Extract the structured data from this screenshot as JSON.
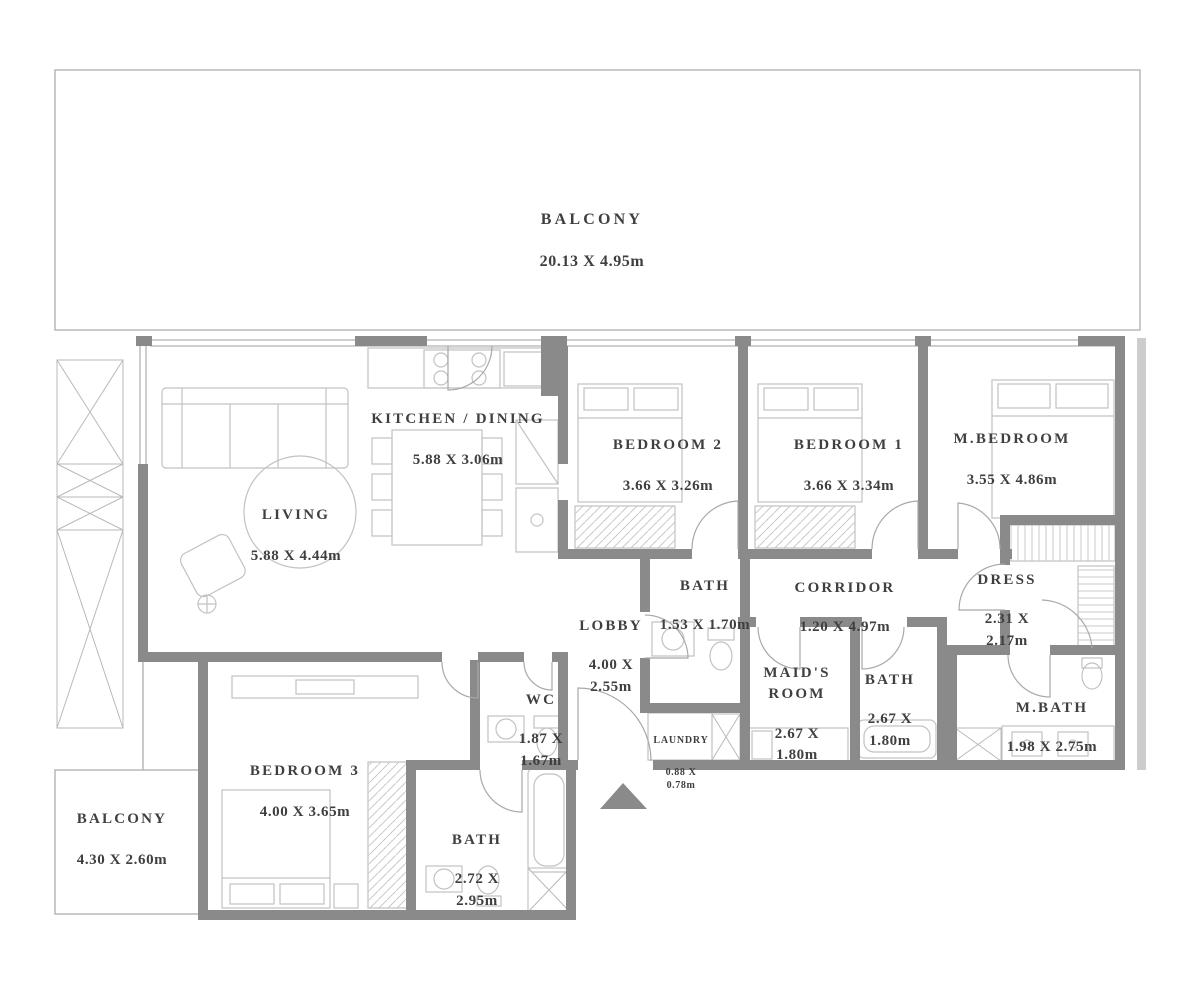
{
  "plan": {
    "type": "apartment-floor-plan",
    "rooms": [
      {
        "id": "balcony-top",
        "name": "BALCONY",
        "dims": "20.13 X 4.95m"
      },
      {
        "id": "kitchen-dining",
        "name": "KITCHEN / DINING",
        "dims": "5.88 X 3.06m"
      },
      {
        "id": "living",
        "name": "LIVING",
        "dims": "5.88 X 4.44m"
      },
      {
        "id": "bedroom-2",
        "name": "BEDROOM 2",
        "dims": "3.66 X 3.26m"
      },
      {
        "id": "bedroom-1",
        "name": "BEDROOM 1",
        "dims": "3.66 X 3.34m"
      },
      {
        "id": "m-bedroom",
        "name": "M.BEDROOM",
        "dims": "3.55 X 4.86m"
      },
      {
        "id": "bath-hall",
        "name": "BATH",
        "dims": "1.53 X 1.70m"
      },
      {
        "id": "corridor",
        "name": "CORRIDOR",
        "dims": "1.20 X 4.97m"
      },
      {
        "id": "dress",
        "name": "DRESS",
        "dims": "2.31 X\n2.17m"
      },
      {
        "id": "lobby",
        "name": "LOBBY",
        "dims": "4.00 X\n2.55m"
      },
      {
        "id": "wc",
        "name": "WC",
        "dims": "1.87 X\n1.67m"
      },
      {
        "id": "laundry",
        "name": "LAUNDRY",
        "dims": "0.88 X\n0.78m"
      },
      {
        "id": "maids-room",
        "name": "MAID'S\nROOM",
        "dims": "2.67 X\n1.80m"
      },
      {
        "id": "bath-maid",
        "name": "BATH",
        "dims": "2.67 X\n1.80m"
      },
      {
        "id": "m-bath",
        "name": "M.BATH",
        "dims": "1.98 X 2.75m"
      },
      {
        "id": "bedroom-3",
        "name": "BEDROOM 3",
        "dims": "4.00 X 3.65m"
      },
      {
        "id": "balcony-lower",
        "name": "BALCONY",
        "dims": "4.30 X 2.60m"
      },
      {
        "id": "bath-bedroom3",
        "name": "BATH",
        "dims": "2.72 X\n2.95m"
      }
    ],
    "colors": {
      "wall": "#8a8a8a",
      "thin_line": "#b9b9b9",
      "furniture_line": "#c2c2c2",
      "text": "#3f3f3f",
      "background": "#ffffff"
    },
    "markers": {
      "entrance_arrow": "triangle pointing up at unit entrance"
    }
  }
}
